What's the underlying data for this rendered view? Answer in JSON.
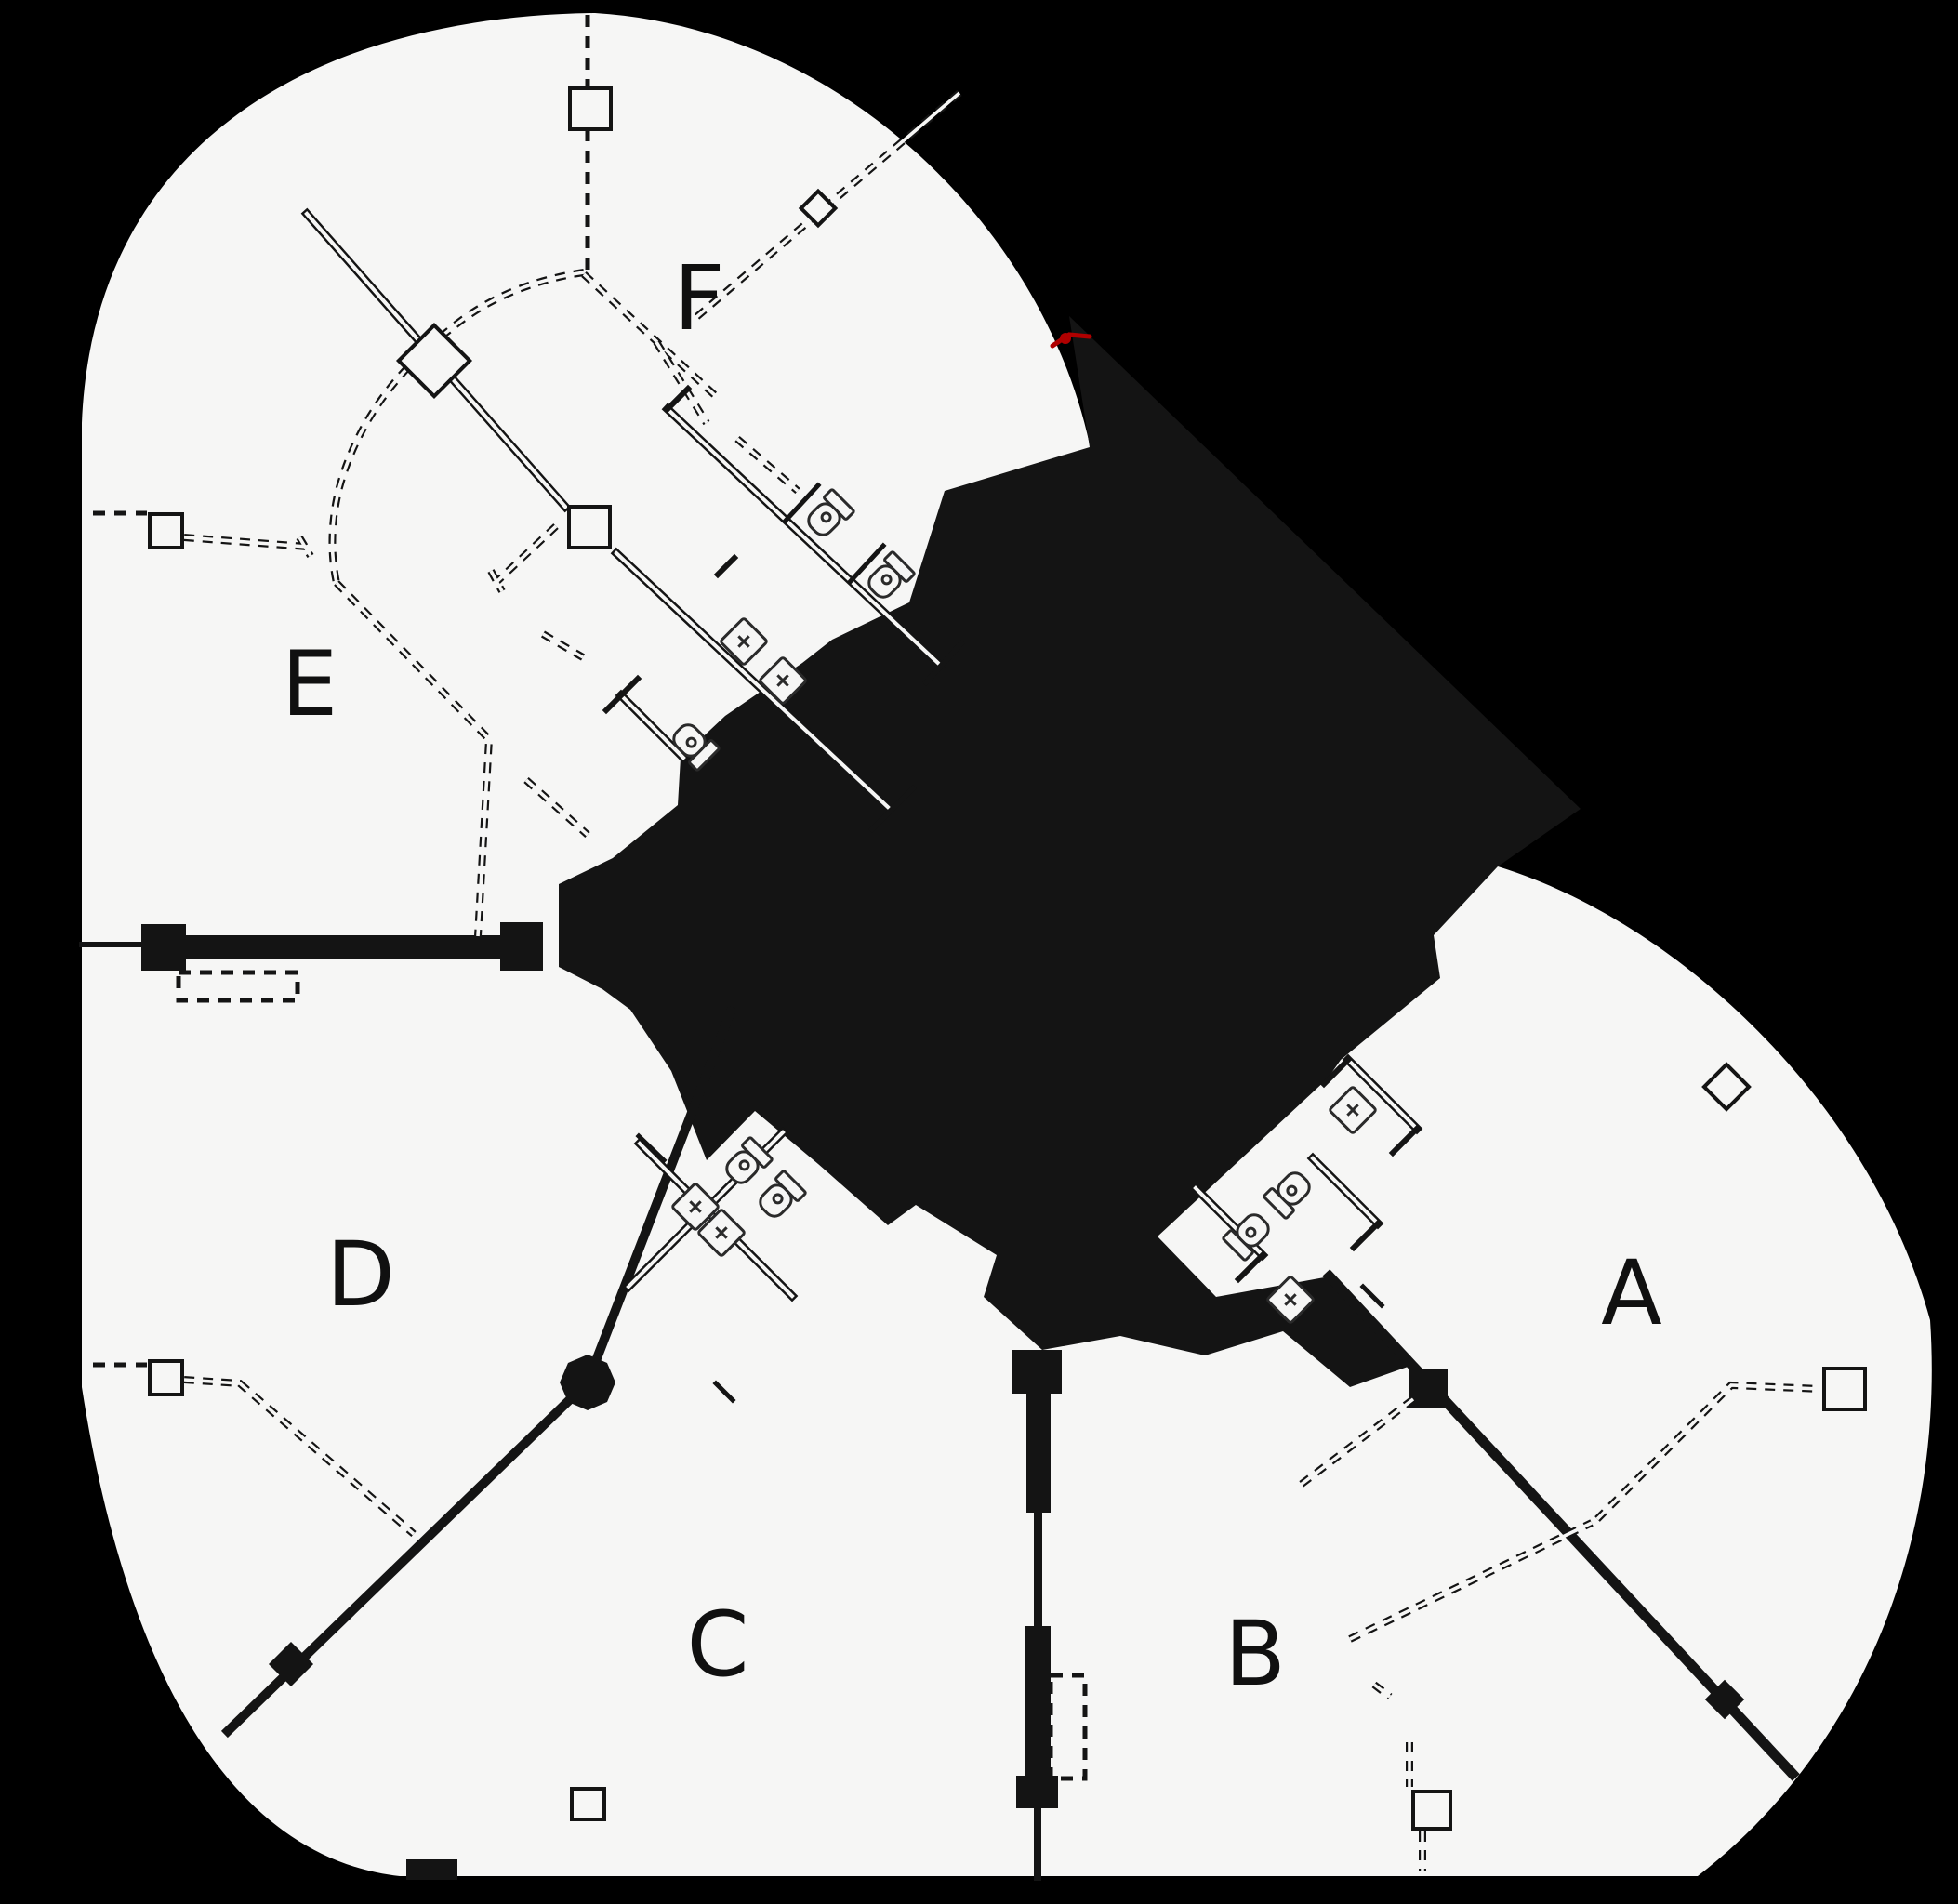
{
  "rooms": [
    {
      "id": "room-a",
      "label": "A"
    },
    {
      "id": "room-b",
      "label": "B"
    },
    {
      "id": "room-c",
      "label": "C"
    },
    {
      "id": "room-d",
      "label": "D"
    },
    {
      "id": "room-e",
      "label": "E"
    },
    {
      "id": "room-f",
      "label": "F"
    }
  ],
  "colors": {
    "background": "#000000",
    "floor": "#f6f6f5",
    "line": "#141414",
    "red_mark": "#b00000"
  }
}
